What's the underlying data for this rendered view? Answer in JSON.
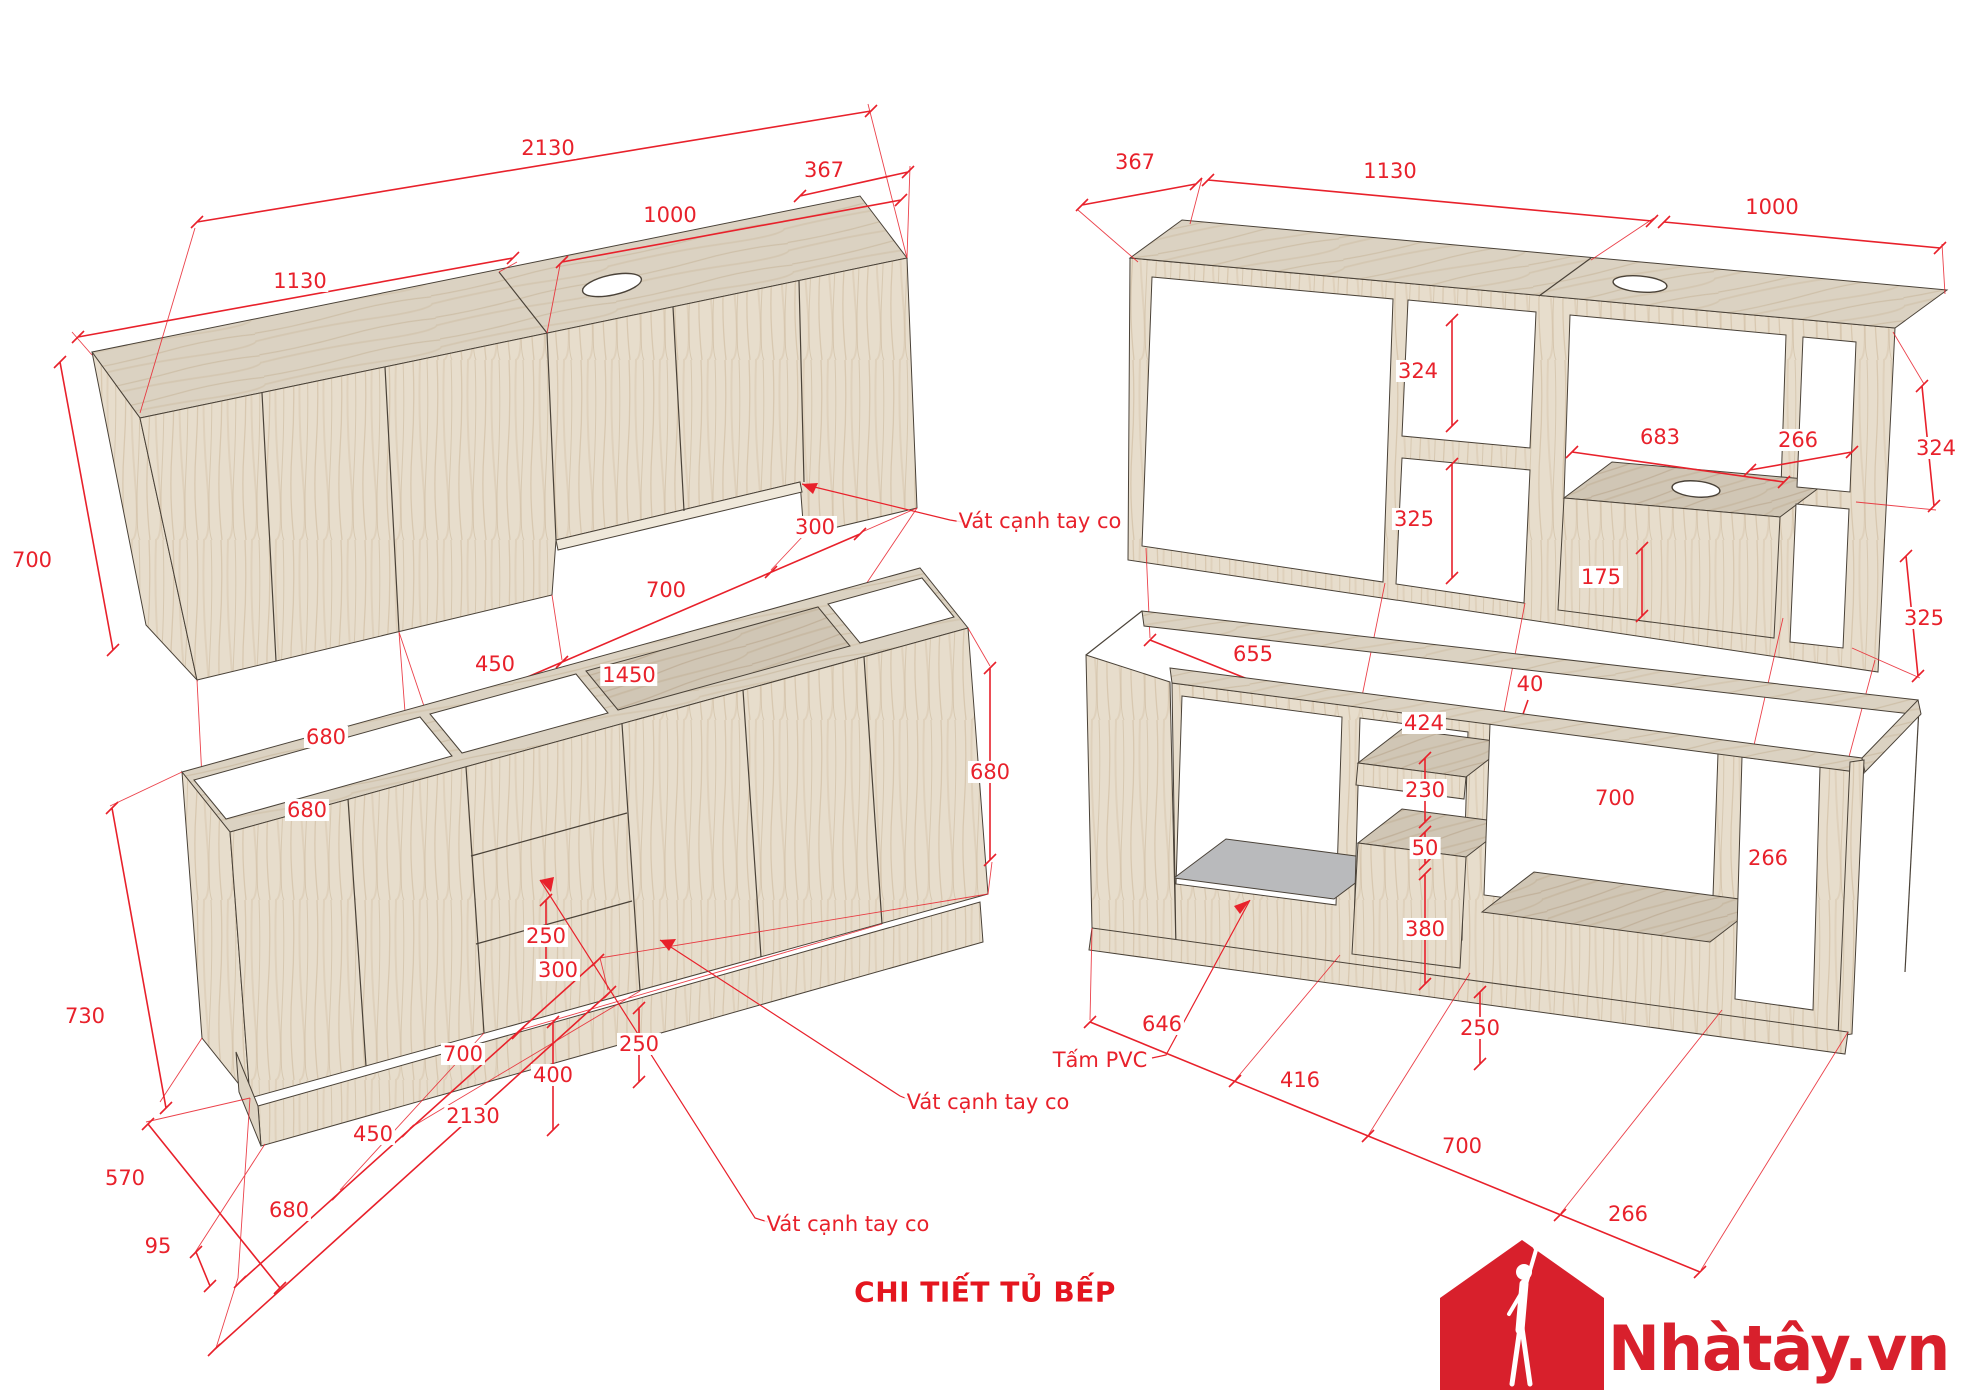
{
  "title": "CHI TIẾT TỦ BẾP",
  "logo": {
    "brand": "Nhàtây.vn",
    "color": "#d8202c"
  },
  "colors": {
    "dimension_red": "#e8212b",
    "title_red": "#e4151e",
    "logo_red": "#d8202c",
    "wood_face": "#e7ddcc",
    "wood_top": "#dbd2c2",
    "wood_floor": "#d0c6b5",
    "pvc_gray": "#b9babc",
    "edge_line": "#4a4238"
  },
  "annotations": {
    "wall_cabinet_front": [
      {
        "text": "2130",
        "x": 548,
        "y": 148
      },
      {
        "text": "1000",
        "x": 670,
        "y": 215
      },
      {
        "text": "1130",
        "x": 300,
        "y": 281
      },
      {
        "text": "367",
        "x": 824,
        "y": 170
      },
      {
        "text": "700",
        "x": 32,
        "y": 560
      },
      {
        "text": "680",
        "x": 326,
        "y": 737
      },
      {
        "text": "450",
        "x": 495,
        "y": 664
      },
      {
        "text": "700",
        "x": 666,
        "y": 590
      },
      {
        "text": "300",
        "x": 815,
        "y": 527
      },
      {
        "text": "680",
        "x": 307,
        "y": 810
      },
      {
        "text": "1450",
        "x": 629,
        "y": 675
      },
      {
        "text": "Vát cạnh tay co",
        "x": 1040,
        "y": 521,
        "kind": "note"
      }
    ],
    "wall_cabinet_back": [
      {
        "text": "367",
        "x": 1135,
        "y": 162
      },
      {
        "text": "1130",
        "x": 1390,
        "y": 171
      },
      {
        "text": "1000",
        "x": 1772,
        "y": 207
      },
      {
        "text": "324",
        "x": 1418,
        "y": 371
      },
      {
        "text": "325",
        "x": 1414,
        "y": 519
      },
      {
        "text": "683",
        "x": 1660,
        "y": 437
      },
      {
        "text": "266",
        "x": 1798,
        "y": 440
      },
      {
        "text": "175",
        "x": 1601,
        "y": 577
      },
      {
        "text": "40",
        "x": 1530,
        "y": 684
      },
      {
        "text": "655",
        "x": 1253,
        "y": 654
      },
      {
        "text": "424",
        "x": 1424,
        "y": 723
      },
      {
        "text": "700",
        "x": 1615,
        "y": 798
      },
      {
        "text": "266",
        "x": 1768,
        "y": 858
      },
      {
        "text": "324",
        "x": 1936,
        "y": 448
      },
      {
        "text": "325",
        "x": 1924,
        "y": 618
      }
    ],
    "base_cabinet_front": [
      {
        "text": "680",
        "x": 289,
        "y": 1210
      },
      {
        "text": "450",
        "x": 373,
        "y": 1134
      },
      {
        "text": "700",
        "x": 463,
        "y": 1054
      },
      {
        "text": "300",
        "x": 558,
        "y": 970
      },
      {
        "text": "2130",
        "x": 473,
        "y": 1116
      },
      {
        "text": "730",
        "x": 85,
        "y": 1016
      },
      {
        "text": "570",
        "x": 125,
        "y": 1178
      },
      {
        "text": "95",
        "x": 158,
        "y": 1246
      },
      {
        "text": "250",
        "x": 546,
        "y": 936
      },
      {
        "text": "250",
        "x": 639,
        "y": 1044
      },
      {
        "text": "400",
        "x": 553,
        "y": 1075
      },
      {
        "text": "680",
        "x": 990,
        "y": 772
      },
      {
        "text": "Vát cạnh tay co",
        "x": 988,
        "y": 1102,
        "kind": "note"
      },
      {
        "text": "Vát cạnh tay co",
        "x": 848,
        "y": 1224,
        "kind": "note"
      }
    ],
    "base_cabinet_back": [
      {
        "text": "230",
        "x": 1425,
        "y": 790
      },
      {
        "text": "50",
        "x": 1425,
        "y": 848
      },
      {
        "text": "380",
        "x": 1425,
        "y": 929
      },
      {
        "text": "250",
        "x": 1480,
        "y": 1028
      },
      {
        "text": "646",
        "x": 1162,
        "y": 1024
      },
      {
        "text": "416",
        "x": 1300,
        "y": 1080
      },
      {
        "text": "700",
        "x": 1462,
        "y": 1146
      },
      {
        "text": "266",
        "x": 1628,
        "y": 1214
      },
      {
        "text": "Tấm PVC",
        "x": 1100,
        "y": 1060,
        "kind": "note"
      }
    ]
  }
}
